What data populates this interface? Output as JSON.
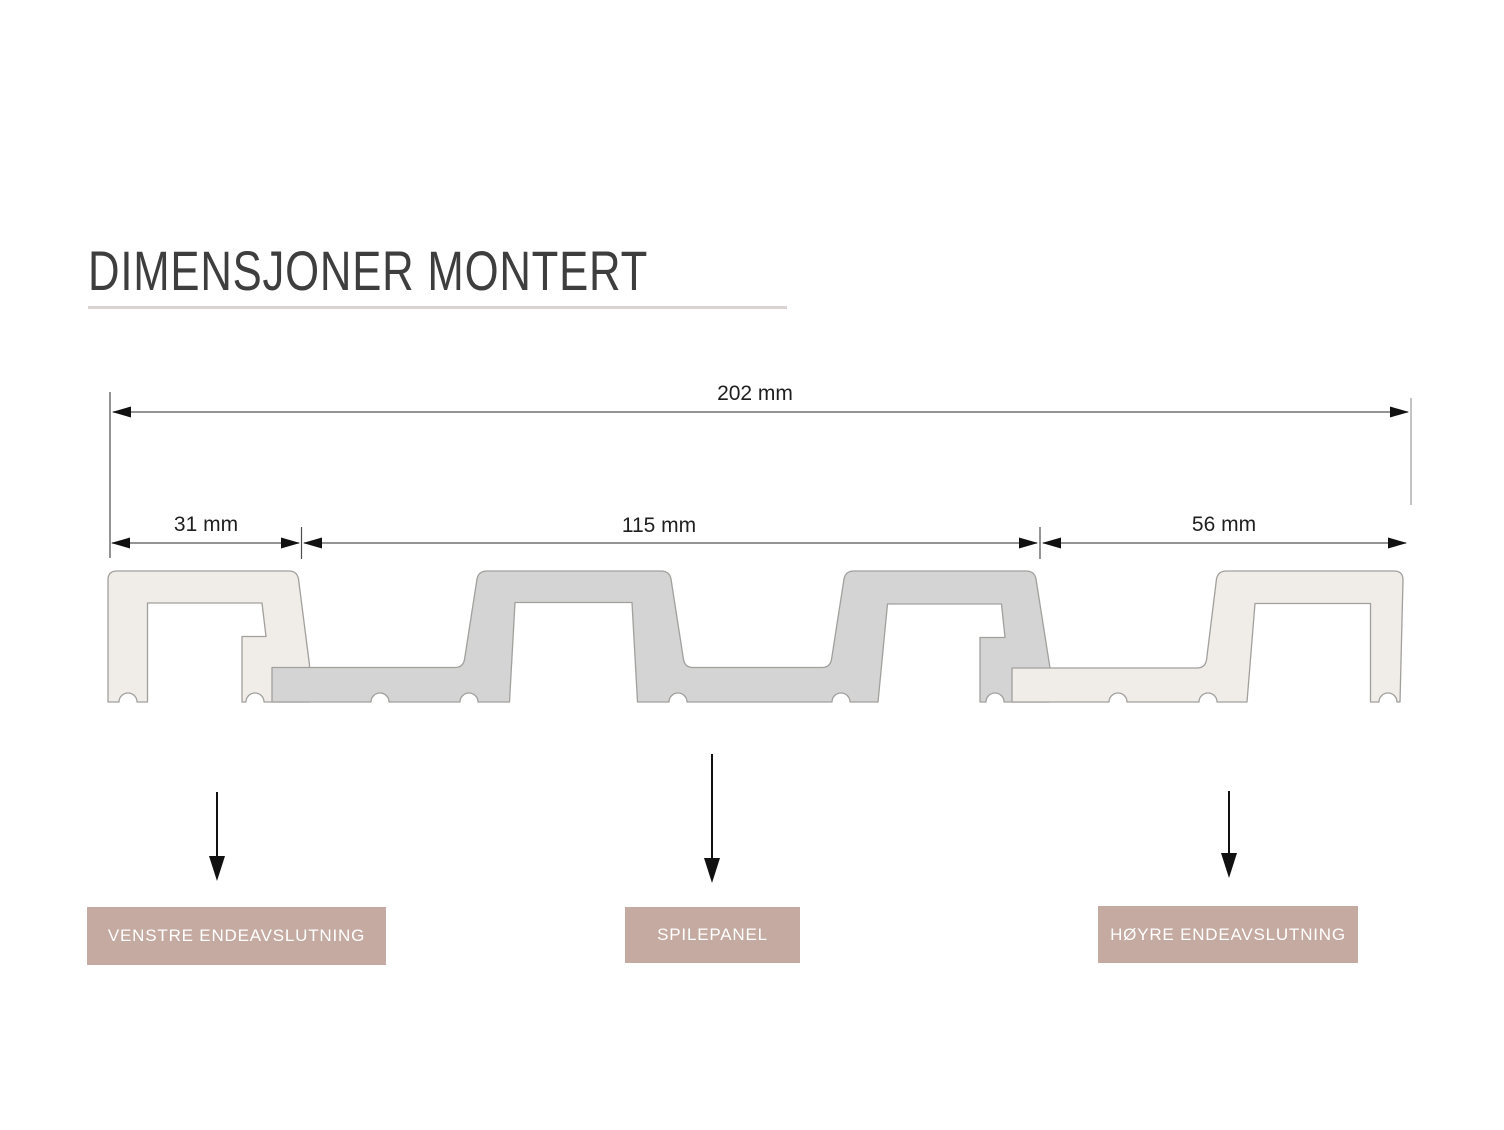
{
  "title": {
    "text": "DIMENSJONER MONTERT"
  },
  "dimension_labels": {
    "total": "202 mm",
    "left_end": "31 mm",
    "panel": "115 mm",
    "right_end": "56 mm"
  },
  "dimension_values_mm": {
    "total": 202,
    "left_end": 31,
    "panel": 115,
    "right_end": 56
  },
  "part_labels": {
    "left": "VENSTRE ENDEAVSLUTNING",
    "middle": "SPILEPANEL",
    "right": "HØYRE ENDEAVSLUTNING"
  },
  "colors": {
    "background": "#ffffff",
    "title_text": "#3e3e3e",
    "title_underline": "#d9d3d2",
    "profile_light_fill": "#f0ece8",
    "profile_gray_fill": "#d4d4d4",
    "profile_outline": "#a2a09d",
    "dimension_line": "#555555",
    "arrowhead": "#111111",
    "label_box_bg": "#c5aaa1",
    "label_box_text": "#ffffff"
  }
}
